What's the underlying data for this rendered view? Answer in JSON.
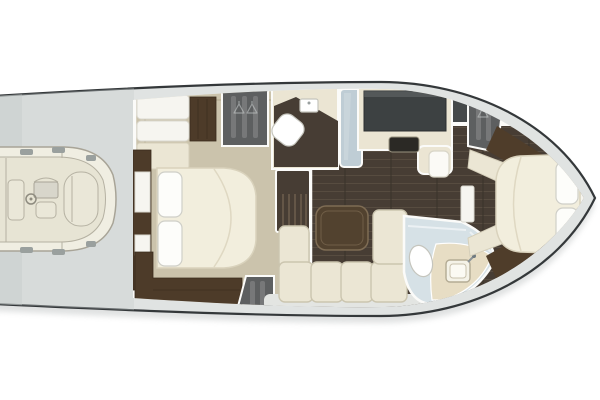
{
  "meta": {
    "diagram_type": "yacht-floorplan",
    "view": "overhead",
    "bow_direction": "right",
    "visible_text": "none"
  },
  "palette": {
    "hull_outline": "#34383a",
    "deck": "#e0e3e2",
    "deck_shade": "#c6cbca",
    "shadow": "#b9bdbd",
    "interior_white": "#fbfbf8",
    "wall_white": "#fbfbf9",
    "carpet": "#cbc3ac",
    "rug_line": "#b2a98f",
    "wood_floor": "#473d34",
    "wood_cabinet": "#4d3b29",
    "wood_cabinet_dark": "#3a2c1d",
    "wood_trim": "#4f3d2a",
    "locker_gray": "#5d5f60",
    "settee_white": "#f6f5f0",
    "bed_cream": "#f2eedd",
    "bed_line": "#d9d2bc",
    "pillow_white": "#fdfdfa",
    "pillow_line": "#cfcfc8",
    "cushion": "#ebe6d4",
    "cushion_line": "#cbc5af",
    "counter_beige": "#ebe5d3",
    "cabinet_white": "#fbfaf6",
    "window_dark": "#3d4142",
    "stove_dark": "#2b2925",
    "glass_blue": "#bfcdd5",
    "bath_floor": "#d6e1e6",
    "bath_counter": "#e7ddc4",
    "sink_fill": "#f4f2e7",
    "fixture_white": "#ffffff",
    "fixture_line": "#c5c5bd",
    "table_wood": "#52422f",
    "table_line": "#7e6c54",
    "tender_tube": "#f0eee2",
    "tender_deck": "#e7e4d4",
    "tender_seat": "#eae7d8",
    "tender_console": "#d8d6cb",
    "tender_line": "#a8a497",
    "tender_patch": "#9aa09e"
  },
  "areas": [
    {
      "id": "swim-platform",
      "contents": [
        "tender-with-console"
      ]
    },
    {
      "id": "aft-cabin",
      "contents": [
        "double-bed",
        "two-pillows",
        "settee",
        "wardrobe",
        "hanging-locker",
        "side-cabinet",
        "lower-cabinets",
        "hanging-locker-aft"
      ]
    },
    {
      "id": "mid-head",
      "contents": [
        "toilet",
        "sink",
        "shower-glass"
      ]
    },
    {
      "id": "galley",
      "contents": [
        "dark-window",
        "cooktop",
        "white-cabinet"
      ]
    },
    {
      "id": "salon",
      "contents": [
        "companionway-stairs",
        "l-shaped-sofa",
        "coffee-table",
        "walkway"
      ]
    },
    {
      "id": "aft-head",
      "contents": [
        "toilet",
        "vanity-sink",
        "glass-partition"
      ]
    },
    {
      "id": "fore-cabin",
      "contents": [
        "double-bed",
        "two-pillows",
        "hanging-locker",
        "side-benches",
        "nightstand"
      ]
    }
  ]
}
